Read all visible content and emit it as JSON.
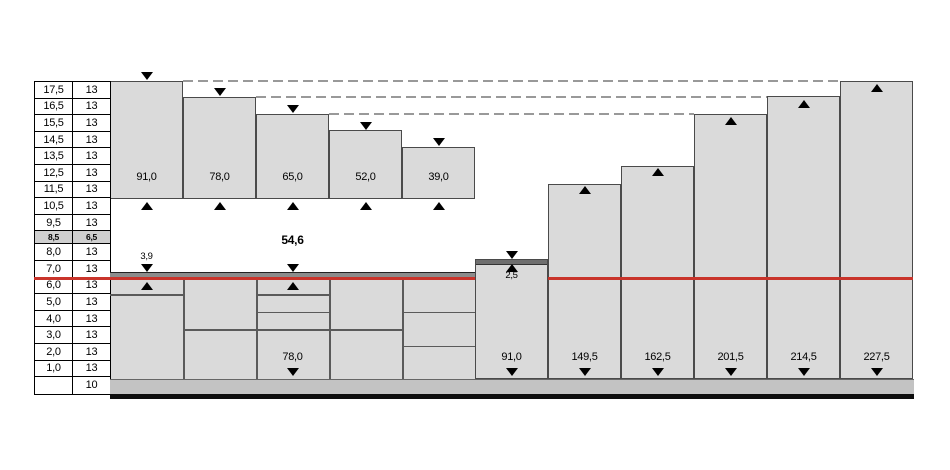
{
  "colors": {
    "red": "#c9342b",
    "bar_fill": "#dadada",
    "strip_dark": "#8c8c8c",
    "band": "#c3c3c3",
    "row_highlight": "#cfcfcf",
    "dash": "#999999",
    "line_dark": "#4a4a4a"
  },
  "table": {
    "rows": [
      {
        "d": "17,5",
        "v": "13"
      },
      {
        "d": "16,5",
        "v": "13"
      },
      {
        "d": "15,5",
        "v": "13"
      },
      {
        "d": "14,5",
        "v": "13"
      },
      {
        "d": "13,5",
        "v": "13"
      },
      {
        "d": "12,5",
        "v": "13"
      },
      {
        "d": "11,5",
        "v": "13"
      },
      {
        "d": "10,5",
        "v": "13"
      },
      {
        "d": "9,5",
        "v": "13"
      },
      {
        "d": "8,5",
        "v": "6,5"
      },
      {
        "d": "8,0",
        "v": "13"
      },
      {
        "d": "7,0",
        "v": "13"
      },
      {
        "d": "6,0",
        "v": "13"
      },
      {
        "d": "5,0",
        "v": "13"
      },
      {
        "d": "4,0",
        "v": "13"
      },
      {
        "d": "3,0",
        "v": "13"
      },
      {
        "d": "2,0",
        "v": "13"
      },
      {
        "d": "1,0",
        "v": "13"
      },
      {
        "d": "",
        "v": "10"
      }
    ]
  },
  "chart_data": {
    "type": "bar",
    "title": "",
    "upper_series": {
      "name": "descending-steps",
      "labels": [
        "91,0",
        "78,0",
        "65,0",
        "52,0",
        "39,0"
      ],
      "values": [
        91.0,
        78.0,
        65.0,
        52.0,
        39.0
      ]
    },
    "lower_series": {
      "name": "ascending-steps",
      "labels": [
        "78,0",
        "91,0",
        "149,5",
        "162,5",
        "201,5",
        "214,5",
        "227,5"
      ],
      "values": [
        78.0,
        91.0,
        149.5,
        162.5,
        201.5,
        214.5,
        227.5
      ]
    },
    "annotations": {
      "bold_mid": "54,6",
      "upper_left": "3,9",
      "step": "2,5"
    },
    "step_module": 13,
    "legend_position": "none",
    "grid": "off"
  }
}
